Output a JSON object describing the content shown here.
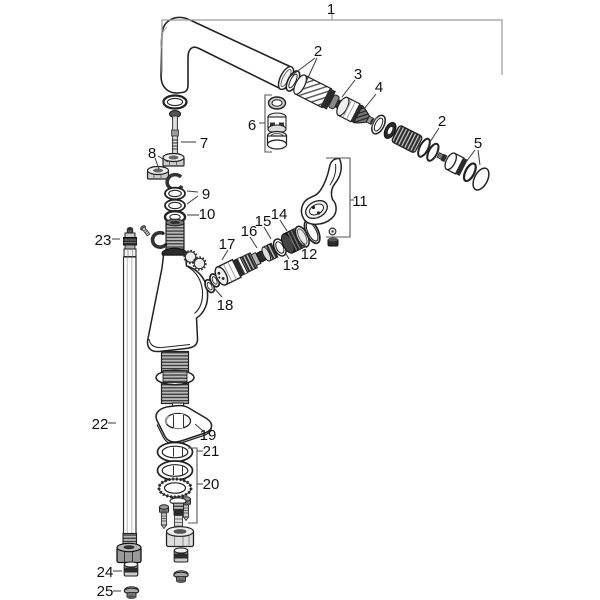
{
  "diagram": {
    "kind": "exploded-parts-drawing",
    "subject": "single-lever kitchen mixer tap with swivel spout, spare parts view",
    "background": "#ffffff"
  },
  "palette": {
    "line": "#1a1a1a",
    "bracket": "#9a9a9a",
    "leader": "#3a3a3a",
    "shade_dark": "#2b2b2b",
    "shade_mid": "#8a8a8a",
    "shade_light": "#d9d9d9",
    "paper": "#ffffff"
  },
  "callouts": {
    "c1": {
      "label": "1"
    },
    "c2a": {
      "label": "2"
    },
    "c3": {
      "label": "3"
    },
    "c4": {
      "label": "4"
    },
    "c2b": {
      "label": "2"
    },
    "c5": {
      "label": "5"
    },
    "c6": {
      "label": "6"
    },
    "c7": {
      "label": "7"
    },
    "c8": {
      "label": "8"
    },
    "c9": {
      "label": "9"
    },
    "c10": {
      "label": "10"
    },
    "c11": {
      "label": "11"
    },
    "c12": {
      "label": "12"
    },
    "c13": {
      "label": "13"
    },
    "c14": {
      "label": "14"
    },
    "c15": {
      "label": "15"
    },
    "c16": {
      "label": "16"
    },
    "c17": {
      "label": "17"
    },
    "c18": {
      "label": "18"
    },
    "c19": {
      "label": "19"
    },
    "c20": {
      "label": "20"
    },
    "c21": {
      "label": "21"
    },
    "c22": {
      "label": "22"
    },
    "c23": {
      "label": "23"
    },
    "c24": {
      "label": "24"
    },
    "c25": {
      "label": "25"
    }
  }
}
